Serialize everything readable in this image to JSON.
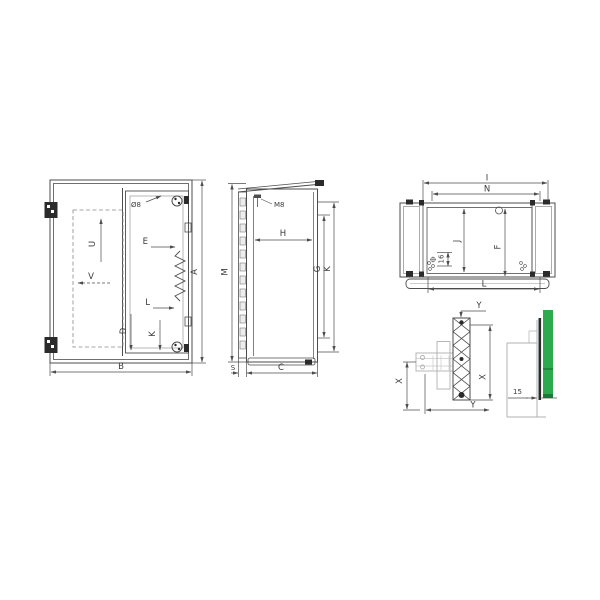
{
  "drawing": {
    "kind": "enclosure-dimension-drawing",
    "colors": {
      "line": "#4d4d4d",
      "light": "#b0b0b0",
      "accent_green": "#2eaa4e",
      "dark": "#2b2b2b"
    }
  },
  "front": {
    "dia": "Ø8",
    "u": "U",
    "v": "V",
    "e": "E",
    "l": "L",
    "d": "D",
    "k": "K",
    "a": "A",
    "b": "B"
  },
  "side": {
    "stud": "M8",
    "m": "M",
    "h": "H",
    "g": "G",
    "k": "K",
    "s": "S",
    "c": "C"
  },
  "top": {
    "i": "I",
    "n": "N",
    "j": "J",
    "f": "F",
    "s16": "16",
    "l": "L"
  },
  "bracket": {
    "y1": "Y",
    "x1": "X",
    "y2": "Y",
    "x2": "X"
  },
  "wall": {
    "gap": "15"
  }
}
